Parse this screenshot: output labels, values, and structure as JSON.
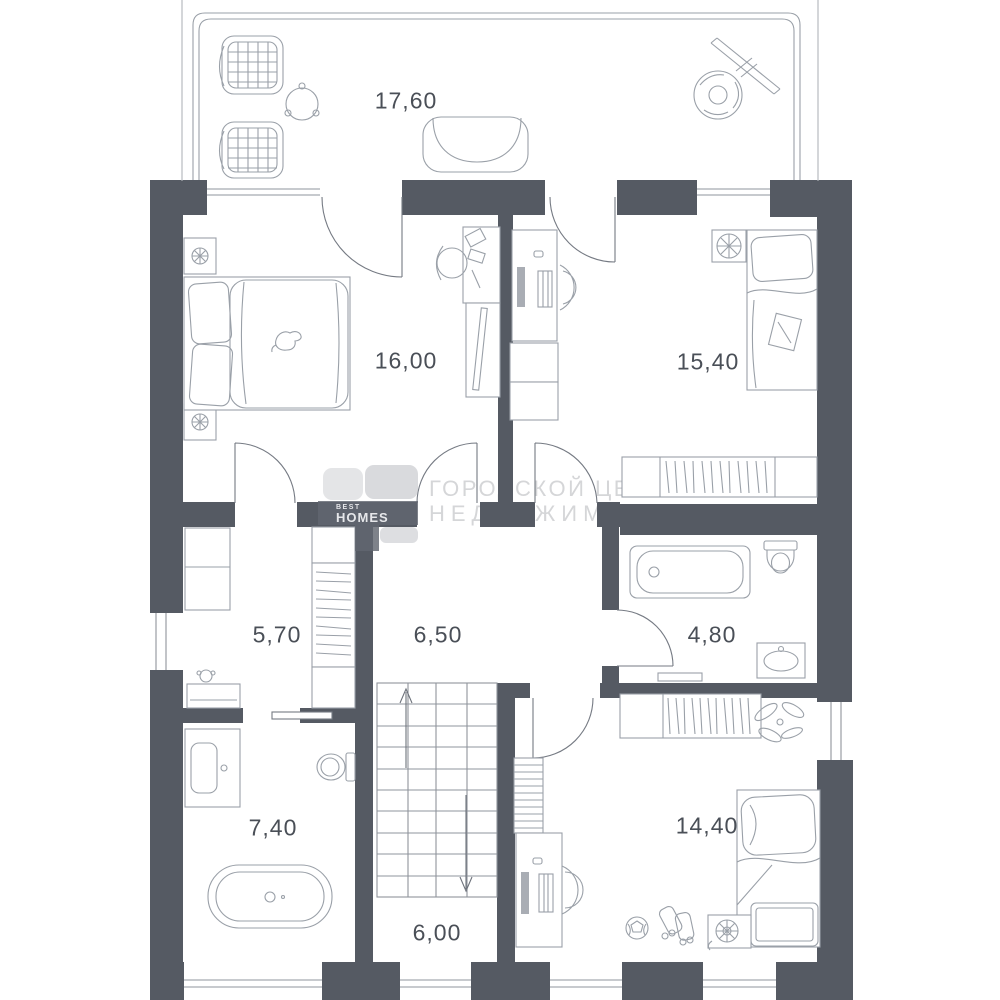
{
  "type": "floor_plan",
  "colors": {
    "wall": "#555a63",
    "furniture_line": "#9aa0a8",
    "door_line": "#757a83",
    "label_text": "#4a4f57",
    "watermark_text": "#d5d6d8",
    "logo_band": "#626770"
  },
  "watermark": {
    "line1": "ГОРОДСКОЙ ЦЕНТР",
    "line2": "НЕДВИЖИМОСТИ"
  },
  "logo": {
    "top_label": "BEST",
    "name": "HOMES"
  },
  "rooms": {
    "terrace": {
      "area_label": "17,60"
    },
    "bedroom_left": {
      "area_label": "16,00"
    },
    "bedroom_right": {
      "area_label": "15,40"
    },
    "wardrobe": {
      "area_label": "5,70"
    },
    "hallway": {
      "area_label": "6,50"
    },
    "bathroom_small": {
      "area_label": "4,80"
    },
    "bathroom_large": {
      "area_label": "7,40"
    },
    "bedroom_bottom": {
      "area_label": "14,40"
    },
    "stair_hall": {
      "area_label": "6,00"
    }
  }
}
